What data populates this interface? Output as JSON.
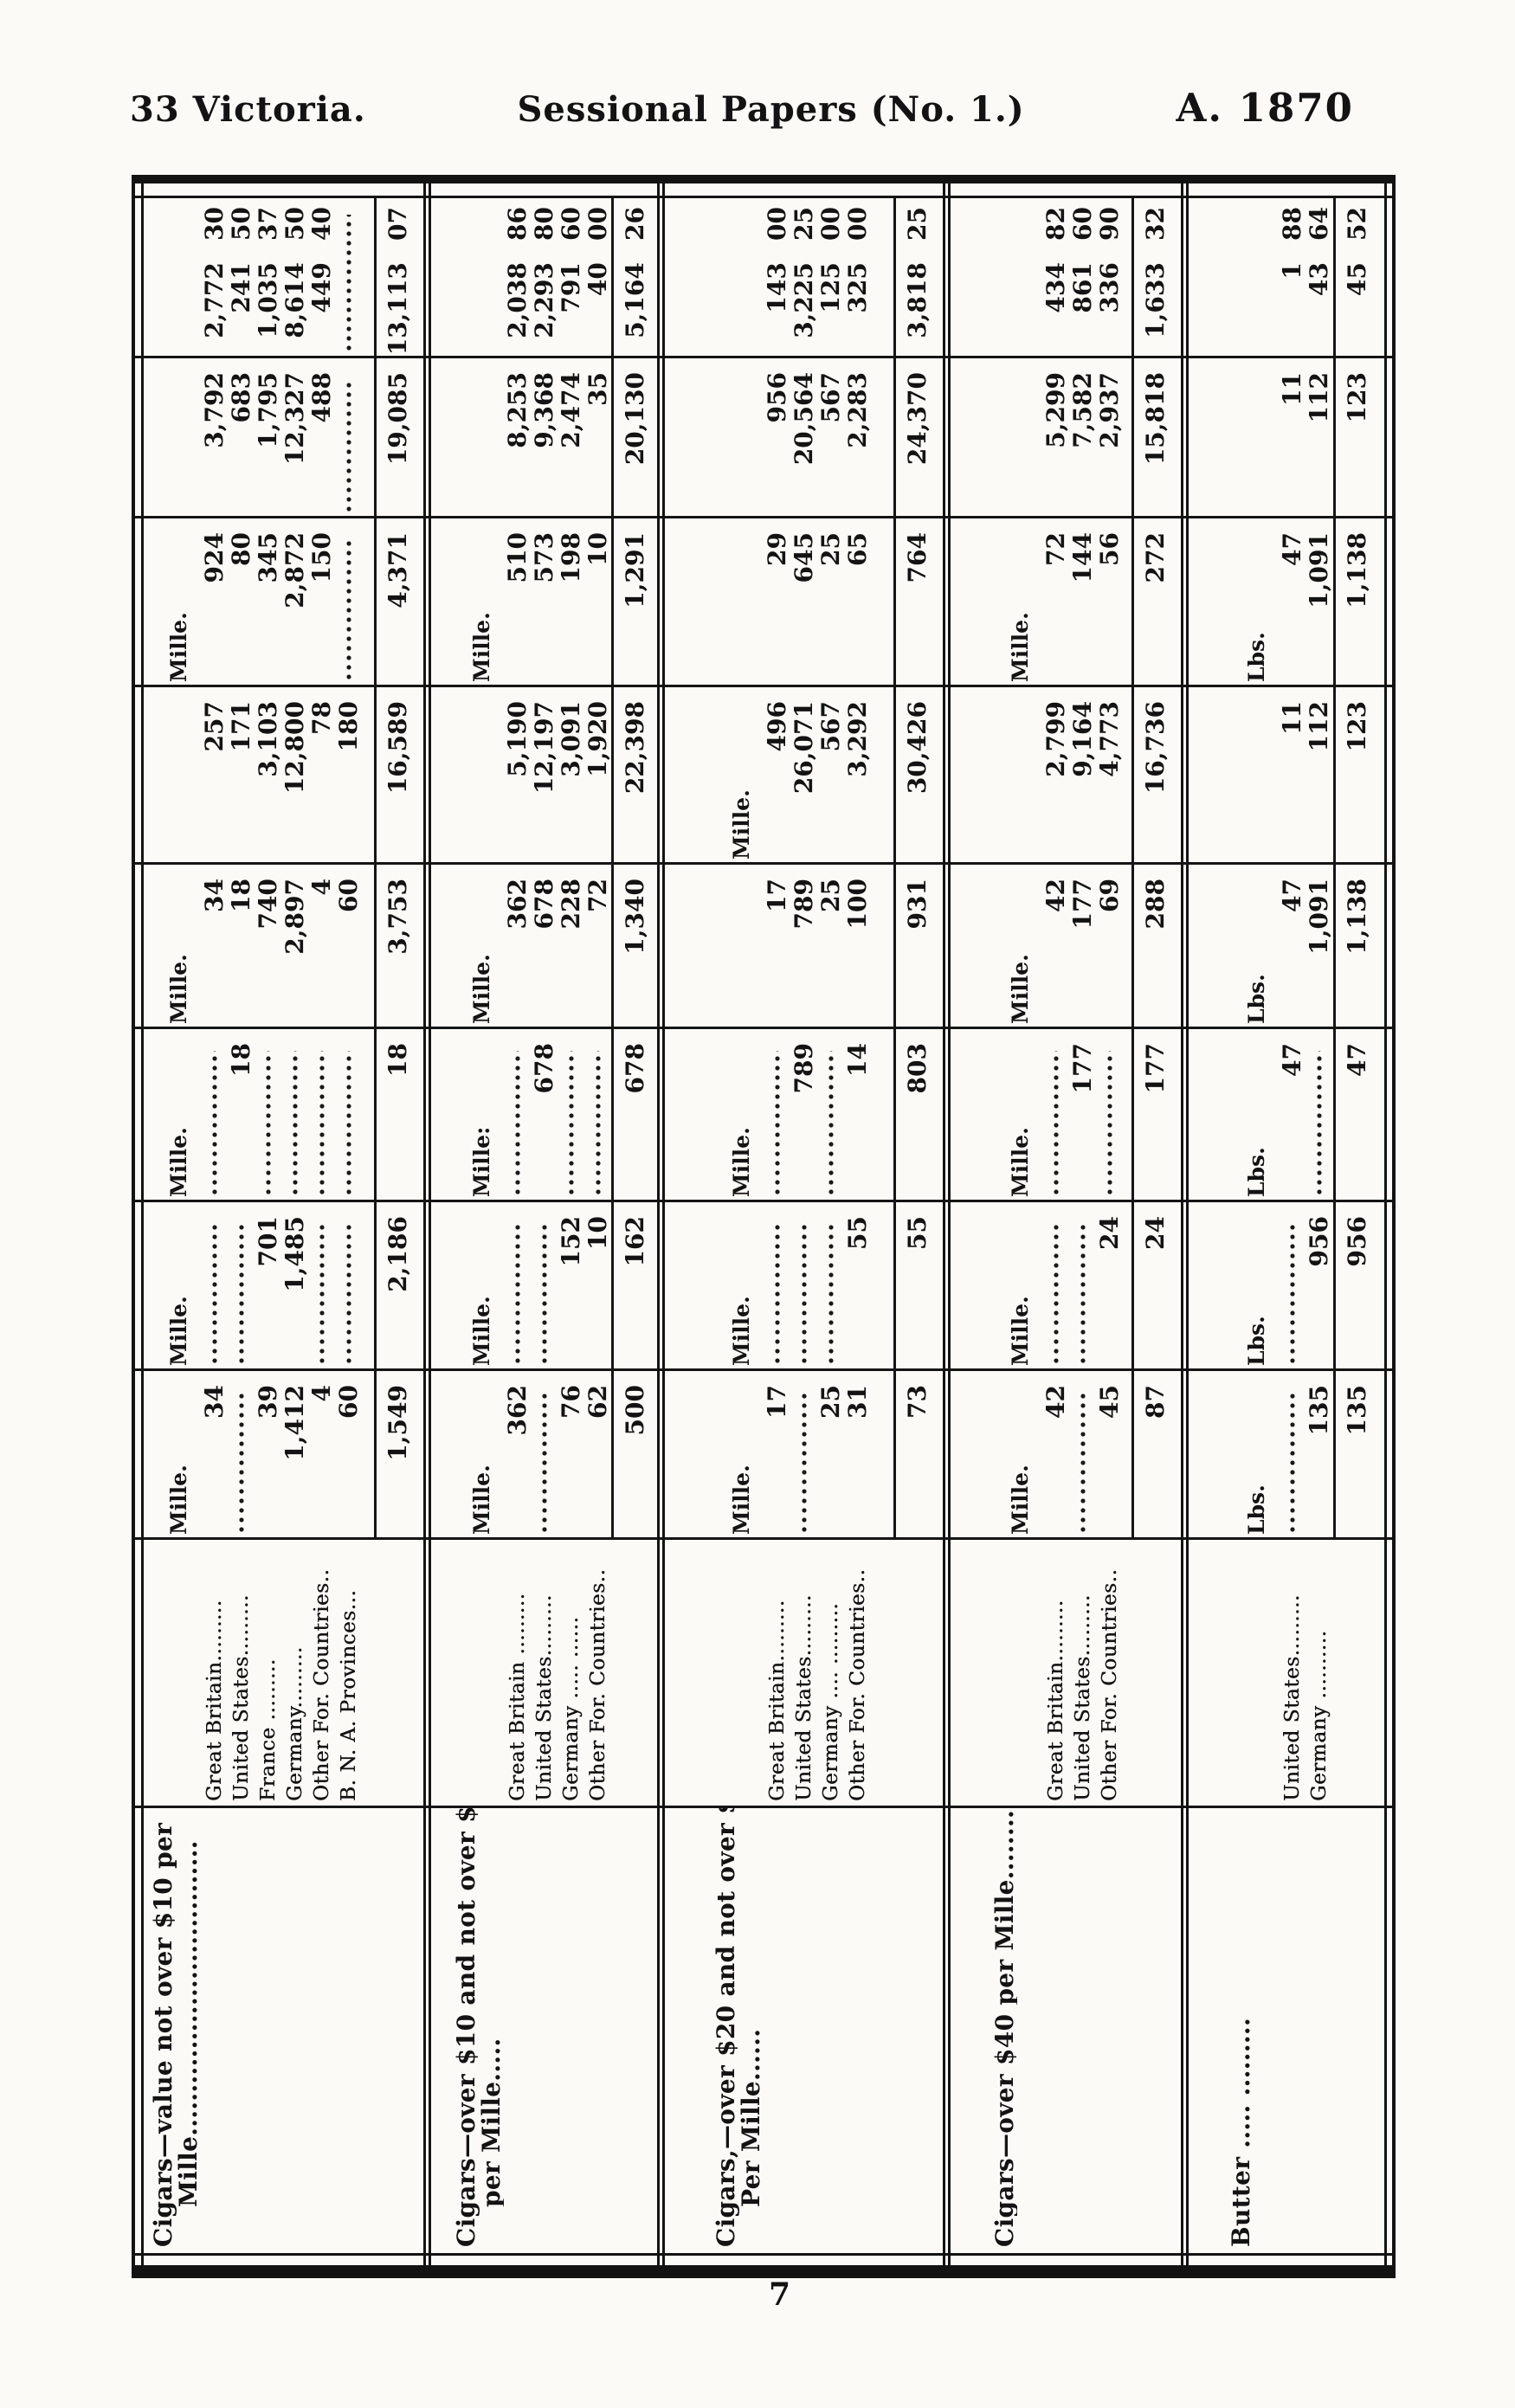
{
  "header": {
    "left": "33 Victoria.",
    "center": "Sessional Papers (No. 1.)",
    "right": "A. 1870"
  },
  "page_number": "7",
  "table": {
    "groups": [
      {
        "article": [
          "Cigars—value not over $10 per",
          "Mille.................................."
        ],
        "units": [
          "Mille.",
          "Mille.",
          "Mille.",
          "Mille.",
          "",
          "Mille.",
          "",
          ""
        ],
        "rows": [
          {
            "country": "Great Britain.........",
            "cells": [
              "34",
              "",
              "",
              "34",
              "257",
              "924",
              "3,792",
              "2,772 30"
            ]
          },
          {
            "country": "United States.........",
            "cells": [
              "",
              "",
              "18",
              "18",
              "171",
              "80",
              "683",
              "241 50"
            ]
          },
          {
            "country": "France .........",
            "cells": [
              "39",
              "701",
              "",
              "740",
              "3,103",
              "345",
              "1,795",
              "1,035 37"
            ]
          },
          {
            "country": "Germany.........",
            "cells": [
              "1,412",
              "1,485",
              "",
              "2,897",
              "12,800",
              "2,872",
              "12,327",
              "8,614 50"
            ]
          },
          {
            "country": "Other For. Countries..",
            "cells": [
              "4",
              "",
              "",
              "4",
              "78",
              "150",
              "488",
              "449 40"
            ]
          },
          {
            "country": "B. N. A. Provinces...",
            "cells": [
              "60",
              "",
              "",
              "60",
              "180",
              "",
              "",
              ""
            ]
          }
        ],
        "totals": [
          "1,549",
          "2,186",
          "18",
          "3,753",
          "16,589",
          "4,371",
          "19,085",
          "13,113 07"
        ]
      },
      {
        "article": [
          "Cigars—over $10 and not over $20",
          "per Mille....."
        ],
        "units": [
          "Mille.",
          "Mille.",
          "Mille:",
          "Mille.",
          "",
          "Mille.",
          "",
          ""
        ],
        "rows": [
          {
            "country": "Great Britain .........",
            "cells": [
              "362",
              "",
              "",
              "362",
              "5,190",
              "510",
              "8,253",
              "2,038 86"
            ]
          },
          {
            "country": "United States.........",
            "cells": [
              "",
              "",
              "678",
              "678",
              "12,197",
              "573",
              "9,368",
              "2,293 80"
            ]
          },
          {
            "country": "Germany ..... ......",
            "cells": [
              "76",
              "152",
              "",
              "228",
              "3,091",
              "198",
              "2,474",
              "791 60"
            ]
          },
          {
            "country": "Other For. Countries..",
            "cells": [
              "62",
              "10",
              "",
              "72",
              "1,920",
              "10",
              "35",
              "40 00"
            ]
          }
        ],
        "totals": [
          "500",
          "162",
          "678",
          "1,340",
          "22,398",
          "1,291",
          "20,130",
          "5,164 26"
        ]
      },
      {
        "article": [
          "Cigars,—over $20 and not over $40",
          "Per Mille......"
        ],
        "units": [
          "Mille.",
          "Mille.",
          "Mille.",
          "",
          "Mille.",
          "",
          "",
          ""
        ],
        "rows": [
          {
            "country": "Great Britain.........",
            "cells": [
              "17",
              "",
              "",
              "17",
              "496",
              "29",
              "956",
              "143 00"
            ]
          },
          {
            "country": "United States.........",
            "cells": [
              "",
              "",
              "789",
              "789",
              "26,071",
              "645",
              "20,564",
              "3,225 25"
            ]
          },
          {
            "country": "Germany .... .........",
            "cells": [
              "25",
              "",
              "",
              "25",
              "567",
              "25",
              "567",
              "125 00"
            ]
          },
          {
            "country": "Other For. Countries..",
            "cells": [
              "31",
              "55",
              "14",
              "100",
              "3,292",
              "65",
              "2,283",
              "325 00"
            ]
          }
        ],
        "totals": [
          "73",
          "55",
          "803",
          "931",
          "30,426",
          "764",
          "24,370",
          "3,818 25"
        ]
      },
      {
        "article": [
          "Cigars—over $40 per Mille........."
        ],
        "units": [
          "Mille.",
          "Mille.",
          "Mille.",
          "Mille.",
          "",
          "Mille.",
          "",
          ""
        ],
        "rows": [
          {
            "country": "Great Britain.........",
            "cells": [
              "42",
              "",
              "",
              "42",
              "2,799",
              "72",
              "5,299",
              "434 82"
            ]
          },
          {
            "country": "United States.........",
            "cells": [
              "",
              "",
              "177",
              "177",
              "9,164",
              "144",
              "7,582",
              "861 60"
            ]
          },
          {
            "country": "Other For. Countries..",
            "cells": [
              "45",
              "24",
              "",
              "69",
              "4,773",
              "56",
              "2,937",
              "336 90"
            ]
          }
        ],
        "totals": [
          "87",
          "24",
          "177",
          "288",
          "16,736",
          "272",
          "15,818",
          "1,633 32"
        ]
      },
      {
        "article": [
          "Butter ..... ........."
        ],
        "units": [
          "Lbs.",
          "Lbs.",
          "Lbs.",
          "Lbs.",
          "",
          "Lbs.",
          "",
          ""
        ],
        "rows": [
          {
            "country": "United States.........",
            "cells": [
              "",
              "",
              "47",
              "47",
              "11",
              "47",
              "11",
              "1 88"
            ]
          },
          {
            "country": "Germany ..........",
            "cells": [
              "135",
              "956",
              "",
              "1,091",
              "112",
              "1,091",
              "112",
              "43 64"
            ]
          }
        ],
        "totals": [
          "135",
          "956",
          "47",
          "1,138",
          "123",
          "1,138",
          "123",
          "45 52"
        ]
      }
    ]
  }
}
